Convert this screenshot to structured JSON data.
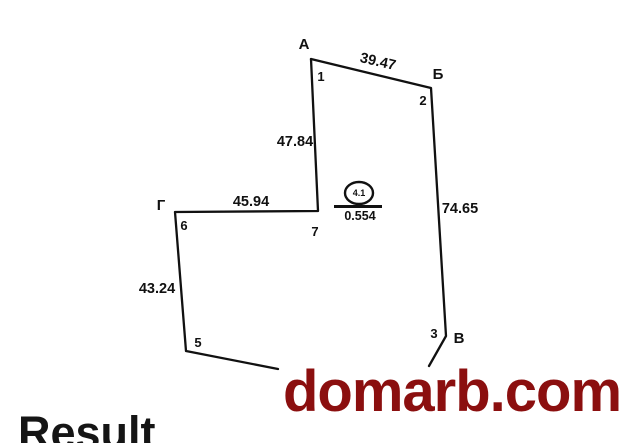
{
  "plan": {
    "vertex_A": "А",
    "vertex_B": "Б",
    "vertex_V": "В",
    "vertex_G": "Г",
    "point_1": "1",
    "point_2": "2",
    "point_3": "3",
    "point_5": "5",
    "point_6": "6",
    "point_7": "7",
    "len_1_2": "39.47",
    "len_2_3": "74.65",
    "len_7_1": "47.84",
    "len_6_7": "45.94",
    "len_6_5": "43.24",
    "parcel_number": "4.1",
    "parcel_area": "0.554"
  },
  "watermark": {
    "text": "domarb.com",
    "color": "#8b0f0f"
  },
  "caption": {
    "text": "Result"
  },
  "colors": {
    "line": "#111111",
    "background": "#ffffff"
  }
}
